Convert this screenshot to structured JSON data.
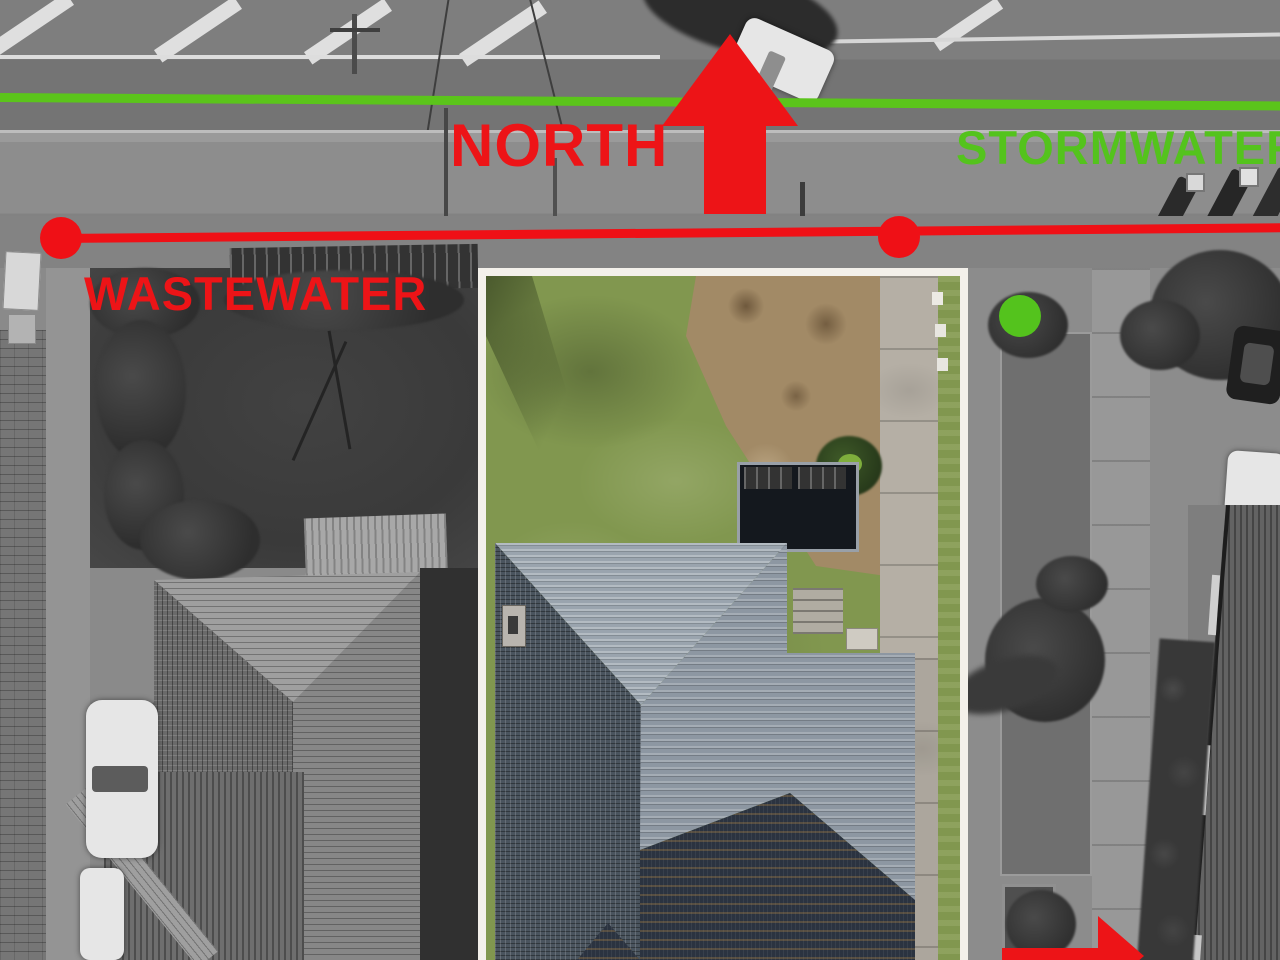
{
  "annotations": {
    "north": {
      "label": "NORTH",
      "icon": "arrow-up",
      "color": "#ed1417"
    },
    "stormwater": {
      "label": "STORMWATER",
      "line": "green-horizontal",
      "marker": "green-dot",
      "color": "#54c31d"
    },
    "wastewater": {
      "label": "WASTEWATER",
      "line": "red-horizontal",
      "markers": [
        "red-dot-left",
        "red-dot-right"
      ],
      "color": "#ee1212"
    },
    "secondary_arrow": {
      "icon": "arrow-right",
      "color": "#ee1212"
    }
  },
  "scene": {
    "description": "aerial photo, central property in colour, surroundings greyscale",
    "highlighted_lot": "central parcel with white boundary outline"
  },
  "colors": {
    "annotation_red": "#ed1417",
    "annotation_green": "#54c31d",
    "line_green": "#5bc41b",
    "line_red": "#ef1016",
    "lot_border": "#f3f0ea",
    "lawn_green": "#81974f",
    "dirt_brown": "#a28a66",
    "concrete": "#b5afa5",
    "roof_light": "#9aa4ae",
    "roof_mid": "#8d97a2",
    "roof_dark": "#4a545e",
    "roof_darkest": "#2b3340"
  }
}
